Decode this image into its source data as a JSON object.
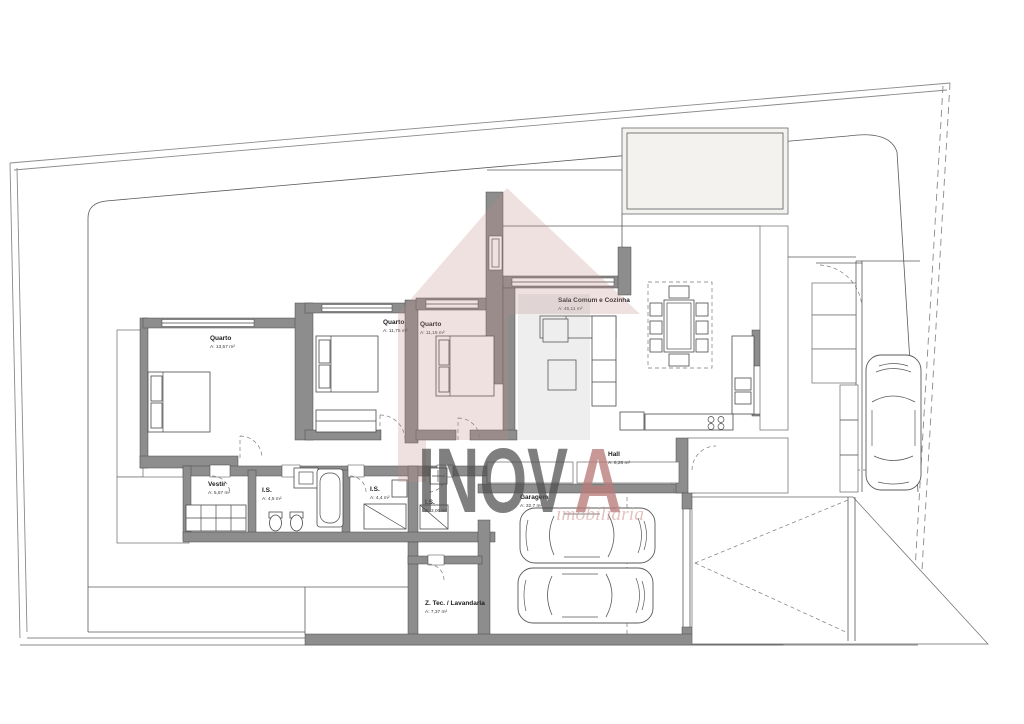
{
  "rooms": [
    {
      "name": "Quarto",
      "area": "A: 13,57 m²"
    },
    {
      "name": "Quarto",
      "area": "A: 11,75 m²"
    },
    {
      "name": "Quarto",
      "area": "A: 11,15 m²"
    },
    {
      "name": "Sala Comum e Cozinha",
      "area": "A: 45,11 m²"
    },
    {
      "name": "Hall",
      "area": "A: 8,28 m²"
    },
    {
      "name": "Vestir",
      "area": "A: 5,67 m²"
    },
    {
      "name": "I.S.",
      "area": "A: 4,5 m²"
    },
    {
      "name": "I.S.",
      "area": "A: 4,4 m²"
    },
    {
      "name": "I.S.",
      "area": "A: 3,06 m²"
    },
    {
      "name": "Garagem",
      "area": "A: 32,7 m²"
    },
    {
      "name": "Z. Tec. / Lavandaria",
      "area": "A: 7,37 m²"
    }
  ],
  "watermark": {
    "brand_main": "INOV",
    "brand_accent": "A",
    "subtitle": "imobiliária"
  },
  "colors": {
    "wall_gray": "#8d8d8d",
    "line_gray": "#5a5a5a",
    "watermark_pink": "#c08a89",
    "watermark_gray": "#9b9b9b",
    "accent_red": "#b97c7a",
    "paper": "#ffffff"
  }
}
